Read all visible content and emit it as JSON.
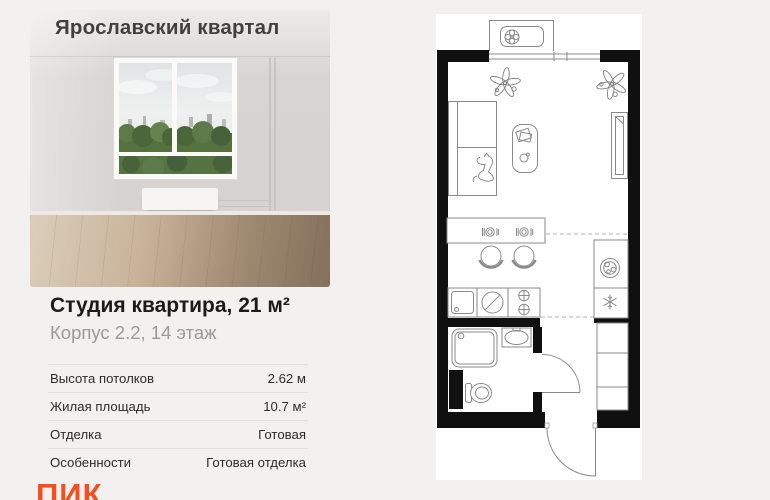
{
  "card": {
    "project_title": "Ярославский квартал",
    "listing_title": "Студия квартира, 21 м²",
    "listing_subtitle": "Корпус 2.2, 14 этаж",
    "specs": [
      {
        "label": "Высота потолков",
        "value": "2.62 м"
      },
      {
        "label": "Жилая площадь",
        "value": "10.7 м²"
      },
      {
        "label": "Отделка",
        "value": "Готовая"
      },
      {
        "label": "Особенности",
        "value": "Готовая отделка"
      }
    ],
    "logo_text": "ПИК"
  },
  "colors": {
    "page_bg": "#f2f1ef",
    "heading": "#1c1b1a",
    "subheading": "#9c9996",
    "divider": "#e3e1de",
    "logo_accent": "#f4501f",
    "plan_wall": "#101010",
    "plan_line": "#8a8a8a",
    "plan_canvas": "#ffffff"
  },
  "floorplan": {
    "icons": [
      "fan-icon",
      "plant-icon",
      "bed-icon",
      "cat-icon",
      "coffee-table-icon",
      "wardrobe-icon",
      "bar-counter-icon",
      "place-setting-icon",
      "stool-icon",
      "sink-icon",
      "stove-icon",
      "burner-icon",
      "washing-machine-icon",
      "snowflake-icon",
      "shower-icon",
      "washbasin-icon",
      "toilet-icon",
      "closet-icon",
      "door-swing-icon",
      "window-icon"
    ]
  }
}
